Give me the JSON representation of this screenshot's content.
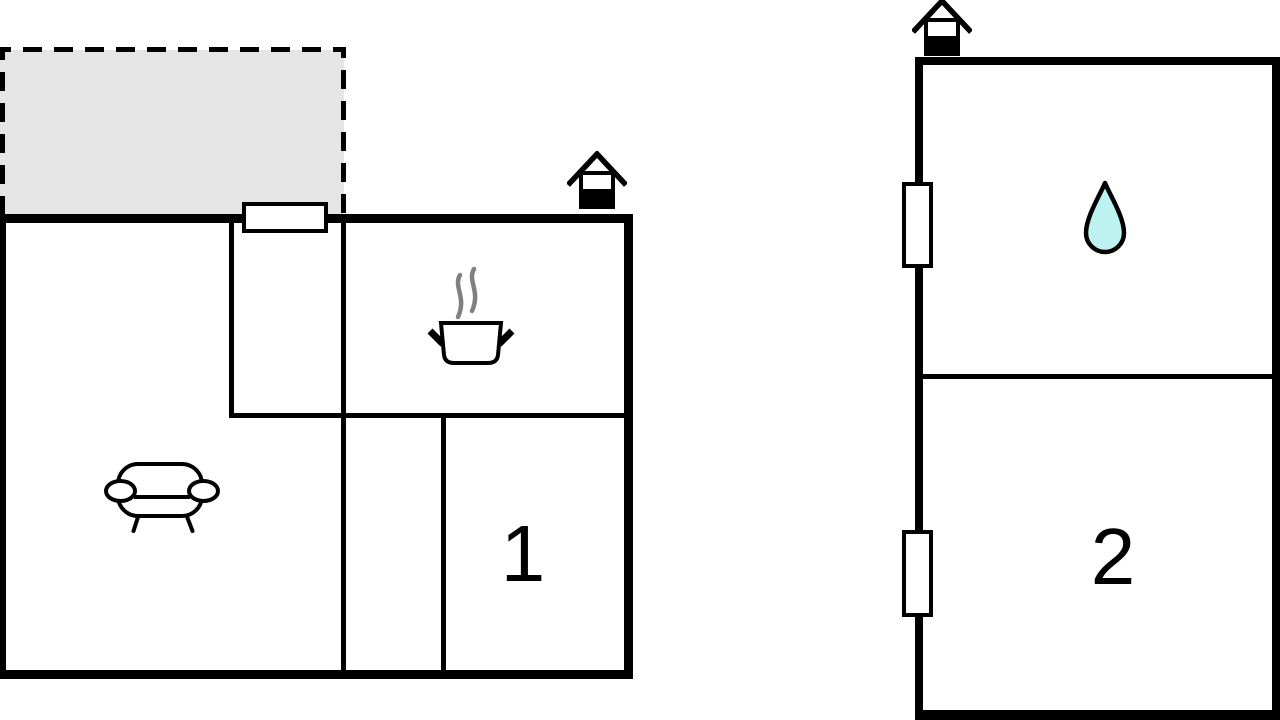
{
  "colors": {
    "background": "#ffffff",
    "wall": "#000000",
    "terrace_fill": "#e5e5e5",
    "terrace_dash": "#000000",
    "water_drop_fill": "#bdf2f1",
    "steam": "#808080"
  },
  "left_building": {
    "room1_label": "1",
    "icons": {
      "entrance": "house-entrance-icon",
      "kitchen": "cooking-pot-icon",
      "living_room": "sofa-icon"
    },
    "features": {
      "terrace": "dashed-outline-area",
      "door": "entrance-door"
    }
  },
  "right_building": {
    "room2_label": "2",
    "icons": {
      "entrance": "house-entrance-icon",
      "bathroom": "water-drop-icon"
    },
    "features": {
      "window_upper": "window",
      "window_lower": "window"
    }
  }
}
